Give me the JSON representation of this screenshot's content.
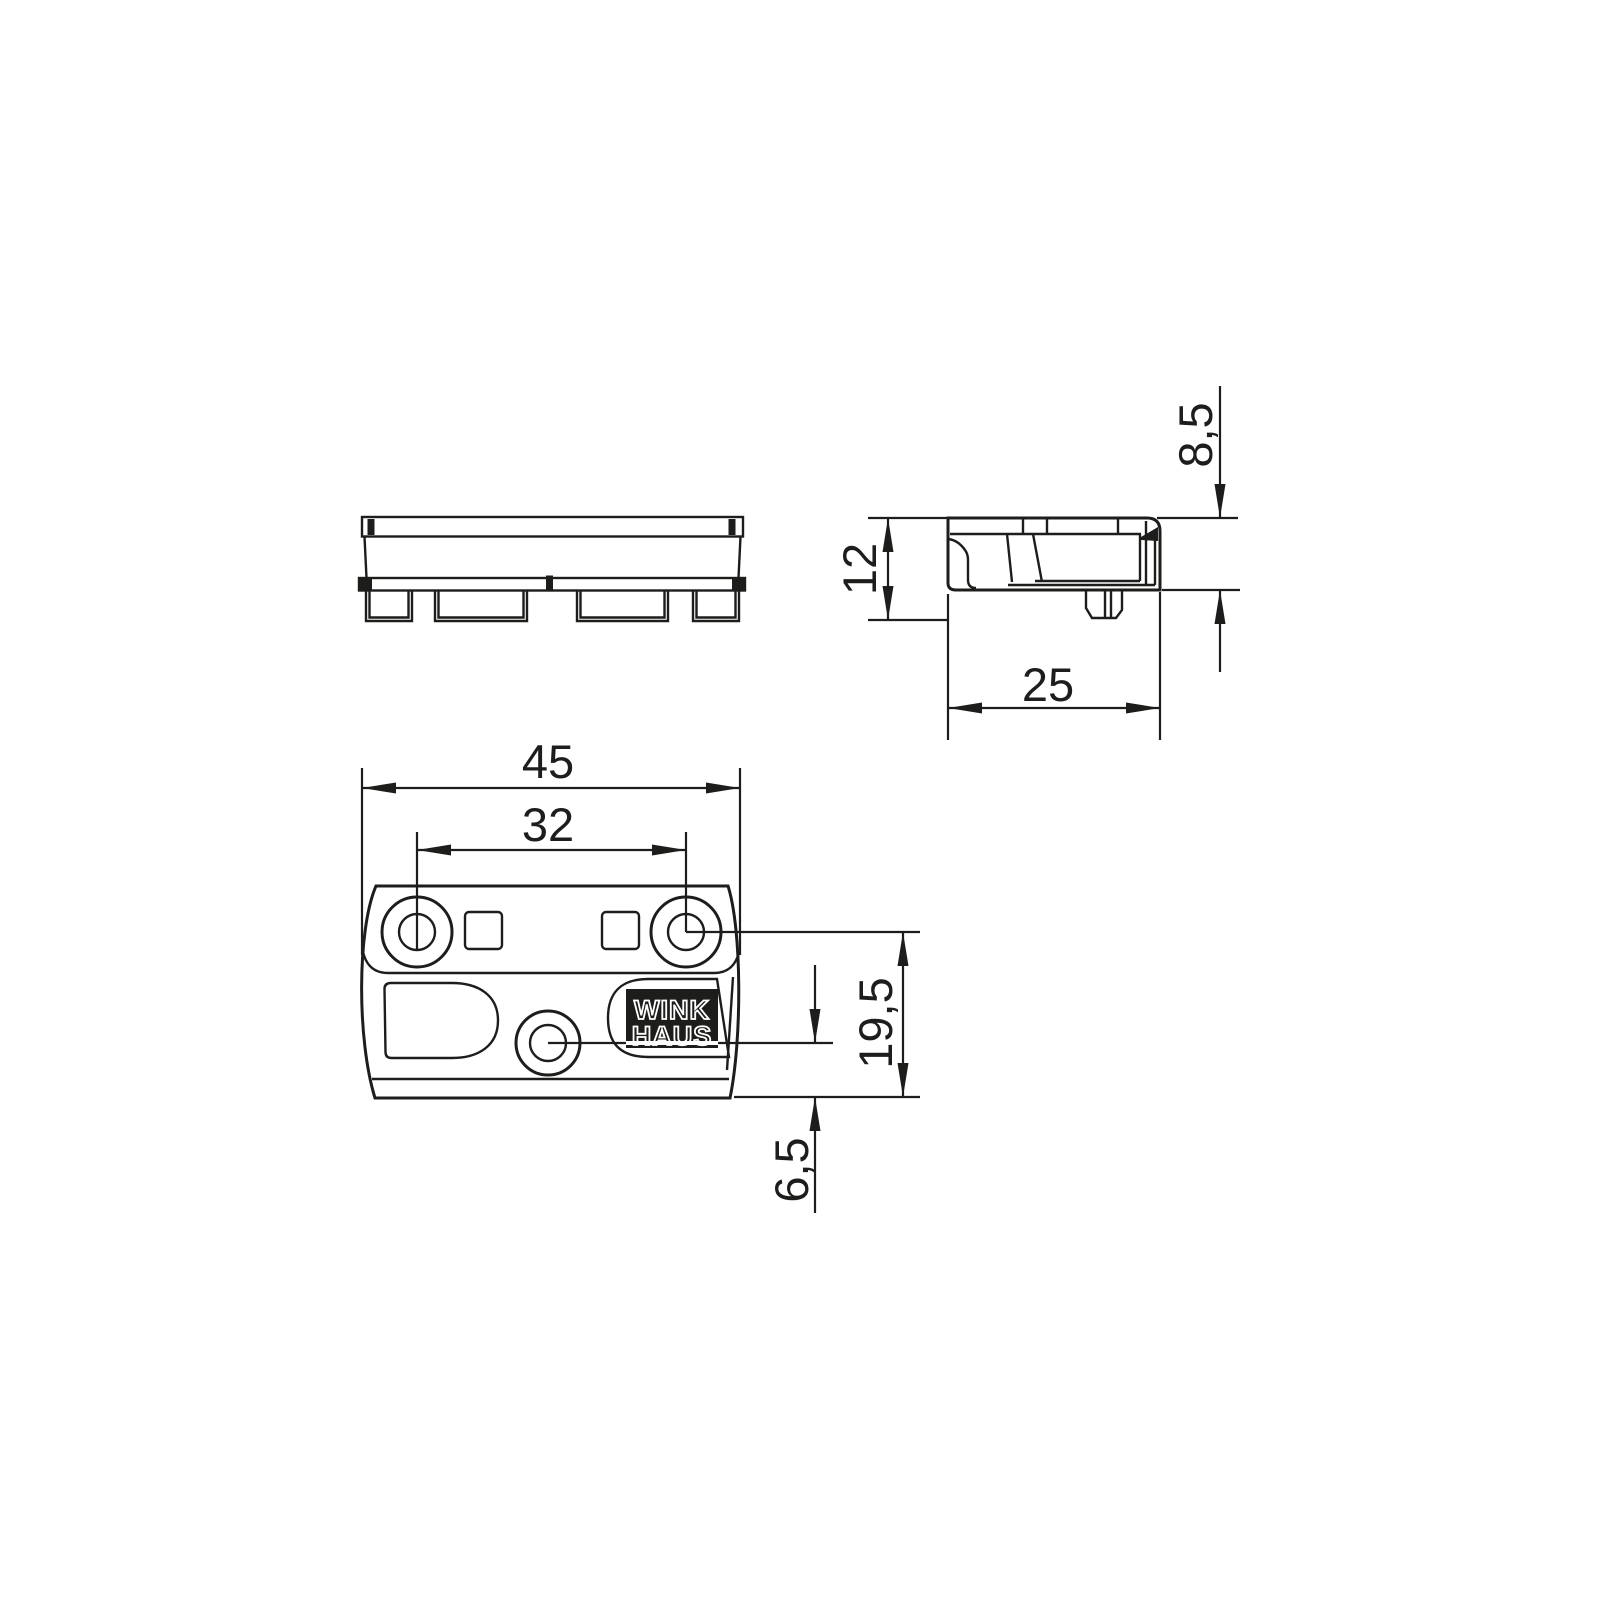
{
  "colors": {
    "line": "#1d1d1b",
    "background": "#ffffff",
    "logo_plate": "#1d1d1b",
    "logo_text": "#ffffff"
  },
  "logo": {
    "line1": "WINK",
    "line2": "HAUS"
  },
  "dimensions": {
    "plan_overall_width": "45",
    "plan_hole_spacing": "32",
    "plan_hole_to_bottom": "19,5",
    "plan_center_hole_to_bottom": "6,5",
    "side_overall_height": "12",
    "side_body_height": "8,5",
    "side_depth": "25"
  }
}
